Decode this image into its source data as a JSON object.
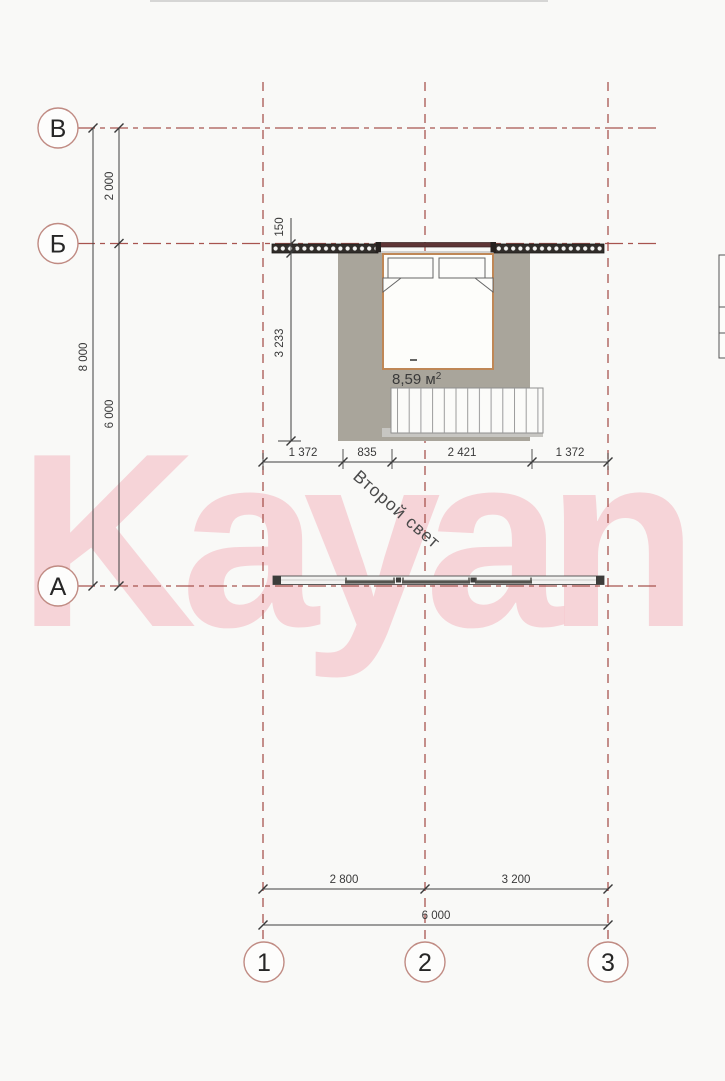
{
  "watermark": {
    "text": "Kayan"
  },
  "axis_markers": {
    "rows": [
      {
        "label": "В"
      },
      {
        "label": "Б"
      },
      {
        "label": "А"
      }
    ],
    "cols": [
      {
        "label": "1"
      },
      {
        "label": "2"
      },
      {
        "label": "3"
      }
    ]
  },
  "dimensions": {
    "left_total": "8 000",
    "left_upper": "2 000",
    "left_lower": "6 000",
    "wall_thickness": "150",
    "room_depth": "3 233",
    "mid_row": [
      "1 372",
      "835",
      "2 421",
      "1 372"
    ],
    "bottom_left_span": "2 800",
    "bottom_right_span": "3 200",
    "bottom_total": "6 000"
  },
  "room": {
    "area_value": "8,59 м",
    "area_sup": "2",
    "void_label": "Второй свет"
  },
  "colors": {
    "axis_red": "#a8544f",
    "floor_gray": "#a9a59b",
    "bed_border": "#bf8756",
    "wall_dark": "#312d2a",
    "window_maroon": "#5f3536",
    "watermark_pink": "#f2a3ae",
    "dim_line": "#3f3f3f"
  }
}
